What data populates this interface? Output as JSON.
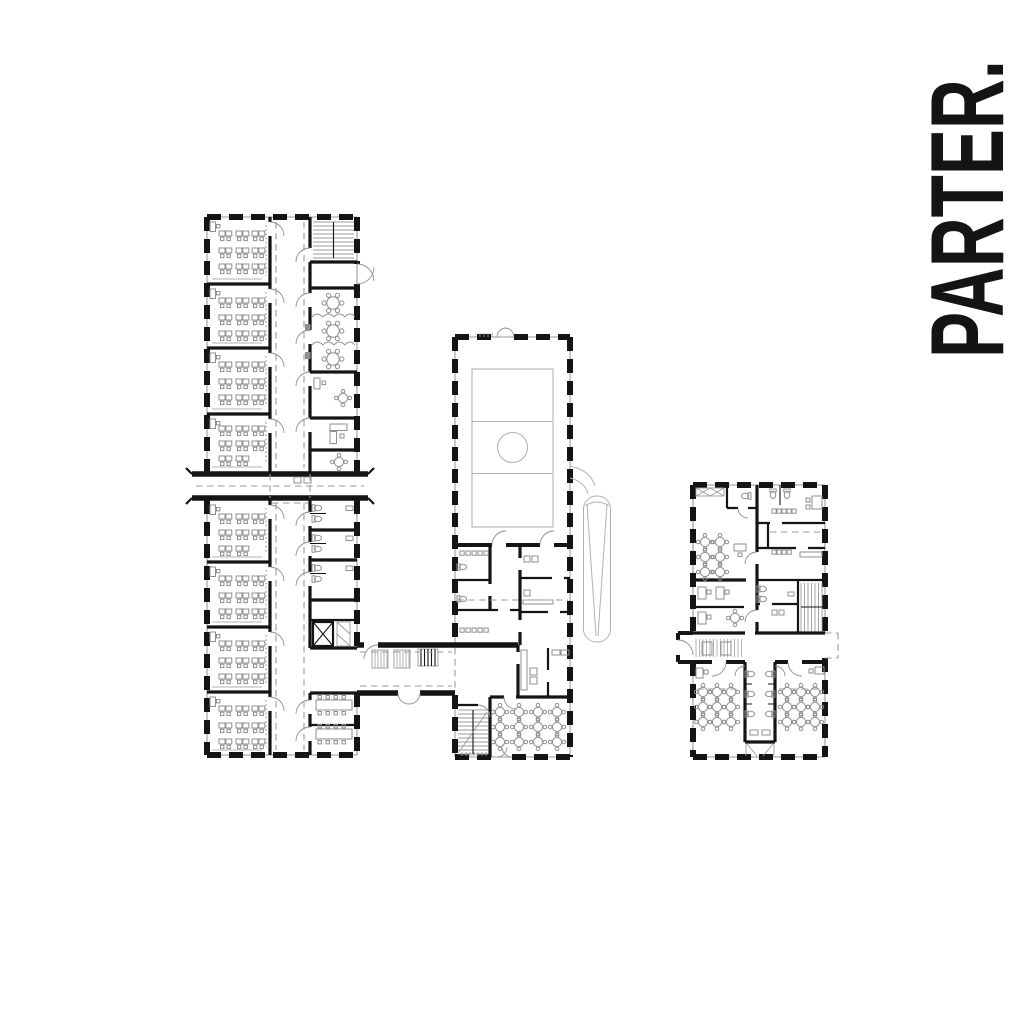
{
  "floor_label": "PARTER.",
  "colors": {
    "bg": "#ffffff",
    "ink": "#141414",
    "furn": "#8f8f8f",
    "detail": "#b3b3b3",
    "dash": "#9a9a9a"
  }
}
